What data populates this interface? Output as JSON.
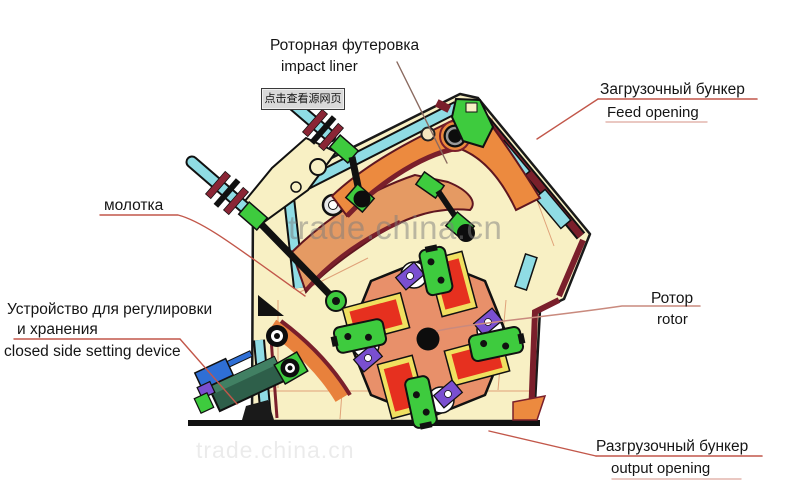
{
  "page": {
    "width": 800,
    "height": 495,
    "background": "#ffffff"
  },
  "watermark": {
    "text": "trade.china.cn",
    "text_faint": "trade.china.cn"
  },
  "source_badge": {
    "text": "点击查看源网页"
  },
  "labels": {
    "impact_liner": {
      "ru": "Роторная футеровка",
      "en": "impact liner"
    },
    "feed_opening": {
      "ru": "Загрузочный бункер",
      "en": "Feed opening"
    },
    "hammer": {
      "ru": "молотка"
    },
    "setting_device": {
      "ru1": "Устройство для регулировки",
      "ru2": "и хранения",
      "en": "closed side setting device"
    },
    "rotor": {
      "ru": "Ротор",
      "en": "rotor"
    },
    "output_opening": {
      "ru": "Разгрузочный бункер",
      "en": "output opening"
    }
  },
  "colors": {
    "body_fill": "#f8f0c4",
    "outline": "#1a1a1a",
    "liner_orange": "#ec8a3f",
    "liner_salmon": "#e59a63",
    "rotor_salmon": "#e8906a",
    "hammer_green": "#3ecb3e",
    "bar_red": "#e6301f",
    "bar_yellow_border": "#f0e060",
    "wedge_purple": "#7a4fd0",
    "pipe_cyan": "#8fdce4",
    "edge_maroon": "#7a1f2b",
    "device_teal": "#2e5f4a",
    "device_blue": "#2f6fd6",
    "leader_red": "#c2574a",
    "watermark_gray": "#7d7d7d"
  }
}
